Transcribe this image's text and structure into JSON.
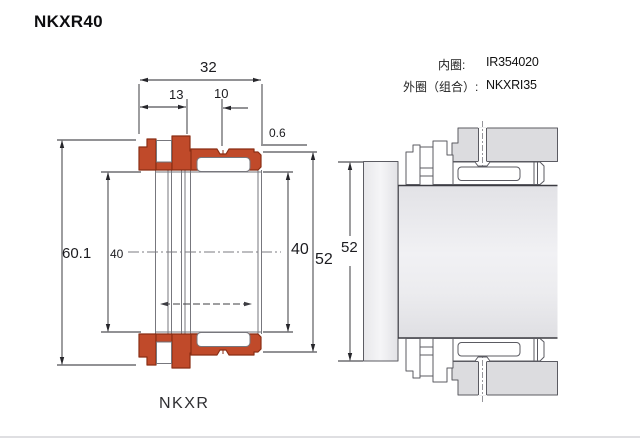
{
  "page": {
    "title": "NKXR40",
    "caption": "NKXR",
    "background": "#ffffff"
  },
  "specs": {
    "rows": [
      {
        "label": "内圈:",
        "value": "IR354020"
      },
      {
        "label": "外圈（组合）:",
        "value": "NKXRI35"
      }
    ]
  },
  "section_drawing": {
    "type": "bearing cross-section",
    "series": "NKXR",
    "colors": {
      "ring_fill": "#c04a2a",
      "ring_stroke": "#8a2e14",
      "line_gray": "#77777d",
      "dim_color": "#26262b"
    },
    "dims": {
      "width_total": "32",
      "width_thrust": "13",
      "width_needle": "10",
      "recess_depth": "0.6",
      "thrust_od": "60.1",
      "bore_left": "40",
      "bore_right": "40",
      "outer_od": "52"
    }
  },
  "mounting_drawing": {
    "type": "mounted application example",
    "dims": {
      "housing_bore": "52"
    }
  }
}
